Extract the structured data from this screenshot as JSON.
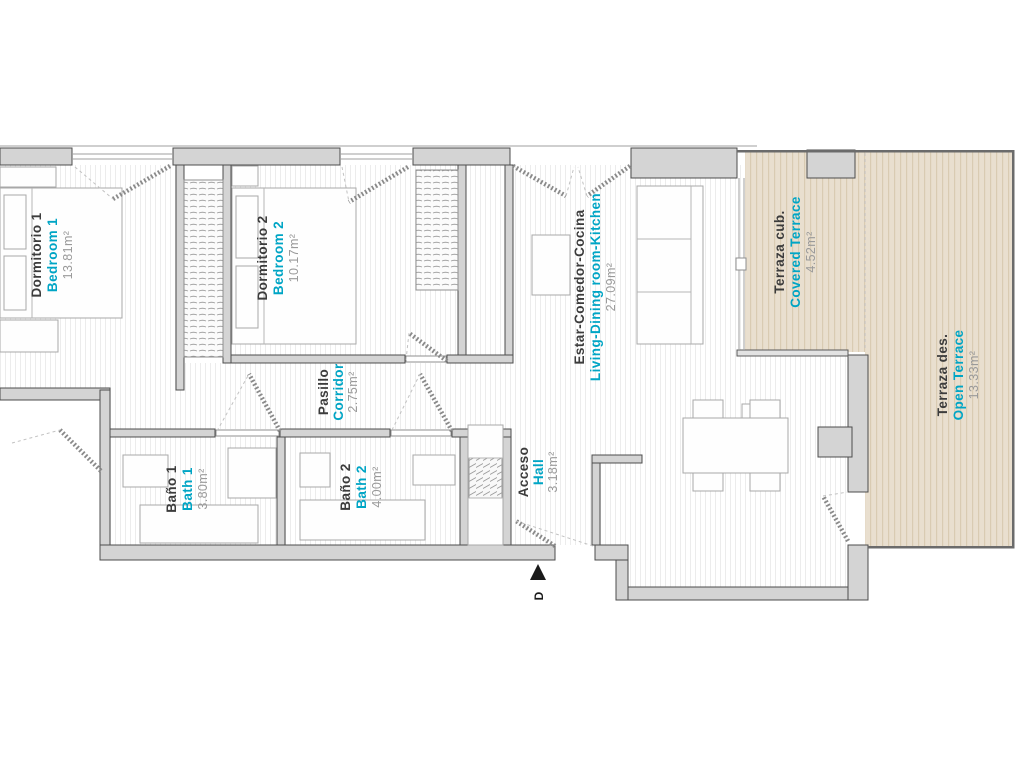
{
  "plan": {
    "entrance_marker": "D",
    "colors": {
      "accent": "#00a5c5",
      "label_dark": "#3c3c3c",
      "area_gray": "#9a9a9a",
      "wall_gray": "#d4d4d4",
      "terrace_beige": "#e9dfcf"
    },
    "rooms": [
      {
        "id": "bedroom-1",
        "name_es": "Dormitorio 1",
        "name_en": "Bedroom 1",
        "area": "13.81m²"
      },
      {
        "id": "bedroom-2",
        "name_es": "Dormitorio 2",
        "name_en": "Bedroom 2",
        "area": "10.17m²"
      },
      {
        "id": "corridor",
        "name_es": "Pasillo",
        "name_en": "Corridor",
        "area": "2.75m²"
      },
      {
        "id": "bath-1",
        "name_es": "Baño 1",
        "name_en": "Bath 1",
        "area": "3.80m²"
      },
      {
        "id": "bath-2",
        "name_es": "Baño 2",
        "name_en": "Bath 2",
        "area": "4.00m²"
      },
      {
        "id": "hall",
        "name_es": "Acceso",
        "name_en": "Hall",
        "area": "3.18m²"
      },
      {
        "id": "living",
        "name_es": "Estar-Comedor-Cocina",
        "name_en": "Living-Dining room-Kitchen",
        "area": "27.09m²"
      },
      {
        "id": "covered-terrace",
        "name_es": "Terraza cub.",
        "name_en": "Covered Terrace",
        "area": "4.52m²"
      },
      {
        "id": "open-terrace",
        "name_es": "Terraza des.",
        "name_en": "Open Terrace",
        "area": "13.33m²"
      }
    ]
  }
}
